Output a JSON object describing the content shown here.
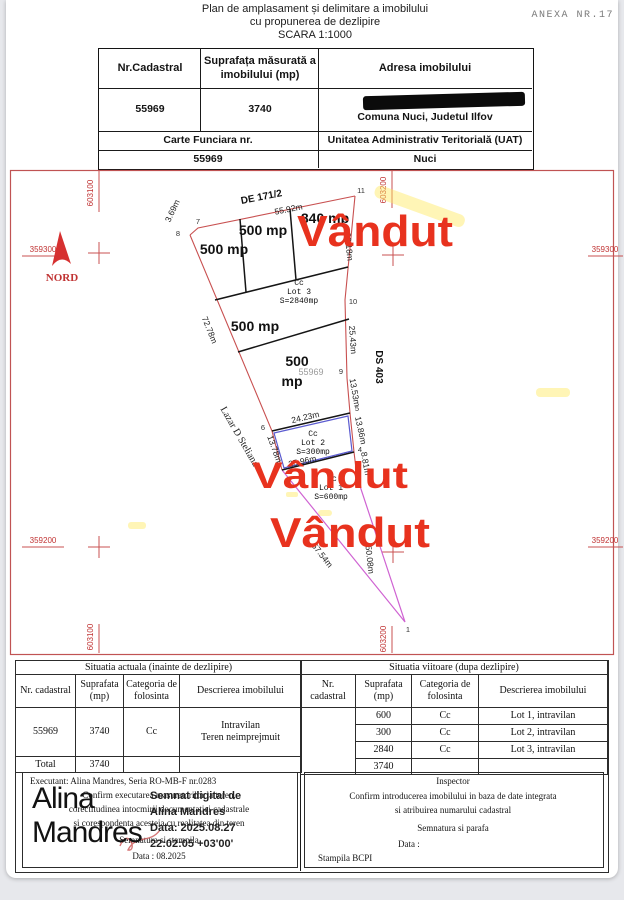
{
  "title": {
    "line1": "Plan de amplasament și delimitare a imobilului",
    "line2": "cu propunerea de dezlipire",
    "line3": "SCARA 1:1000",
    "annex": "ANEXA NR.17"
  },
  "header_table": {
    "col_cadastral": "Nr.Cadastral",
    "col_area": "Suprafața măsurată a imobilului (mp)",
    "col_address": "Adresa imobilului",
    "cadastral_value": "55969",
    "area_value": "3740",
    "address_line2": "Comuna Nuci, Judetul Ilfov",
    "cf_label": "Carte Funciara nr.",
    "cf_value": "55969",
    "uat_label": "Unitatea Administrativ Teritorială (UAT)",
    "uat_value": "Nuci"
  },
  "map": {
    "grid": {
      "x1": "603100",
      "x2": "603200",
      "y1": "359300",
      "y2": "359200"
    },
    "north_label": "NORD",
    "roads": {
      "top": "DE 171/2",
      "right": "DS 403",
      "left": "Lazar D Steliana"
    },
    "dimensions": {
      "top": "55.92m",
      "top_left": "3.69m",
      "left": "72.78m",
      "right1": "36.18m",
      "right2": "25.43m",
      "right3": "13.53m",
      "right4": "13.86m",
      "right5": "8.81m",
      "lot2_top": "24.23m",
      "lot2_left": "13.78m",
      "lot1_top": "25.96m",
      "bottom_left": "57.54m",
      "bottom_right": "50.08m"
    },
    "areas": {
      "strip1": "500 mp",
      "strip2": "500 mp",
      "strip3": "840 mp",
      "strip4": "500 mp",
      "strip5_line1": "500",
      "strip5_line2": "mp"
    },
    "parcel_number": "55969",
    "lots": {
      "lot3": {
        "cc": "Cc",
        "name": "Lot 3",
        "area": "S=2840mp"
      },
      "lot2": {
        "cc": "Cc",
        "name": "Lot 2",
        "area": "S=300mp"
      },
      "lot1": {
        "cc": "Cc",
        "name": "Lot 1",
        "area": "S=600mp"
      }
    },
    "sold_overlay": "Vândut",
    "points": {
      "p1": "1",
      "p4": "4",
      "p5": "5",
      "p6": "6",
      "p7": "7",
      "p8": "8",
      "p9": "9",
      "p10": "10",
      "p11": "11"
    }
  },
  "current_table": {
    "title": "Situatia actuala (inainte de dezlipire)",
    "headers": [
      "Nr. cadastral",
      "Suprafata (mp)",
      "Categoria de folosinta",
      "Descrierea imobilului"
    ],
    "row": {
      "nr": "55969",
      "suprafata": "3740",
      "categoria": "Cc",
      "descriere_line1": "Intravilan",
      "descriere_line2": "Teren neimprejmuit"
    },
    "total_label": "Total",
    "total_value": "3740"
  },
  "future_table": {
    "title": "Situatia viitoare (dupa dezlipire)",
    "headers": [
      "Nr. cadastral",
      "Suprafata (mp)",
      "Categoria de folosinta",
      "Descrierea imobilului"
    ],
    "rows": [
      {
        "suprafata": "600",
        "categoria": "Cc",
        "descriere": "Lot 1, intravilan"
      },
      {
        "suprafata": "300",
        "categoria": "Cc",
        "descriere": "Lot 2, intravilan"
      },
      {
        "suprafata": "2840",
        "categoria": "Cc",
        "descriere": "Lot 3, intravilan"
      }
    ],
    "total_value": "3740"
  },
  "executant": {
    "line1": "Executant: Alina Mandres, Seria RO-MB-F nr.0283",
    "line2": "Confirm executarea masuratorilor la teren,",
    "line3": "corectitudinea intocmirii documentatiei cadastrale",
    "line4": "si corespondenta acesteia cu realitatea din teren",
    "line5": "Semnatura si stampila",
    "line6": "Data : 08.2025"
  },
  "signature": {
    "name_line1": "Alina",
    "name_line2": "Mandres",
    "digital_line1": "Semnat digital de",
    "digital_line2": "Alina Mandres",
    "digital_line3": "Data: 2025.08.27",
    "digital_line4": "22:02:05 +03'00'"
  },
  "inspector": {
    "title": "Inspector",
    "line1": "Confirm introducerea imobilului in baza de date integrata",
    "line2": "si atribuirea numarului cadastral",
    "line3": "Semnatura si parafa",
    "line4": "Data :",
    "line5": "Stampila BCPI"
  }
}
